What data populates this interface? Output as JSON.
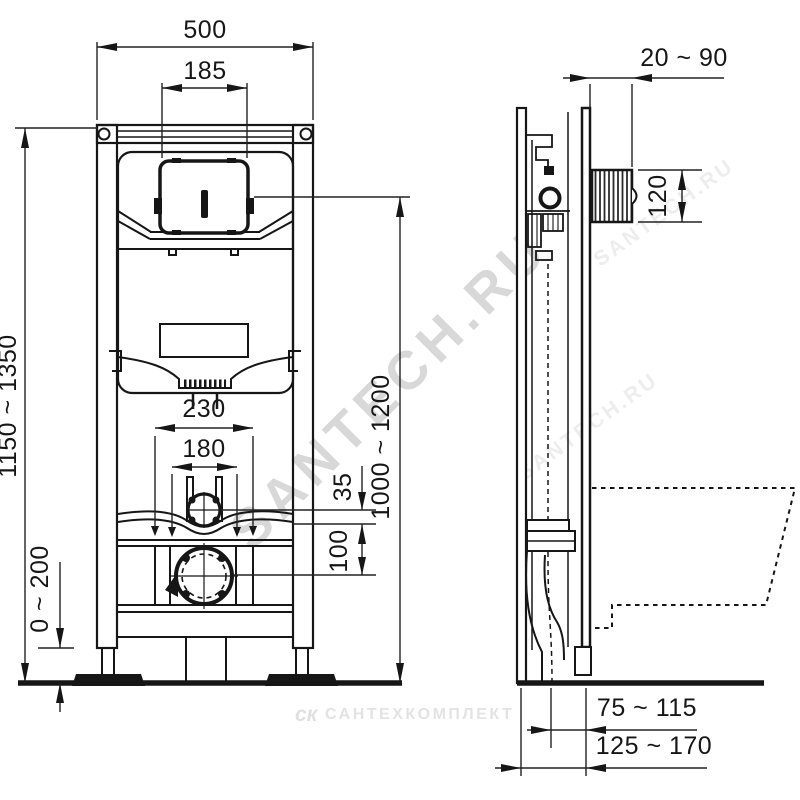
{
  "drawing": {
    "kind": "wall-hung toilet installation frame dimensional drawing",
    "views": {
      "front": "frame front view",
      "side": "frame side view with bowl outline"
    }
  },
  "watermarks": {
    "diagonal_main": "SANTECH.RU",
    "diagonal_faint": "SANTECH.RU",
    "footer_logo": "ск",
    "footer_text": "САНТЕХКОМПЛЕКТ"
  },
  "front_view": {
    "dims": {
      "frame_width": "500",
      "flush_panel_width": "185",
      "frame_height": "1150 ~ 1350",
      "leg_adjustment": "0 ~ 200",
      "fixing_width_outer": "230",
      "fixing_width_inner": "180",
      "flush_pipe_offset": "35",
      "outlet_offset": "100",
      "panel_height": "1000 ~ 1200"
    }
  },
  "side_view": {
    "dims": {
      "wall_distance": "20 ~ 90",
      "access_box_height": "120",
      "outlet_to_wall": "75 ~ 115",
      "frame_depth": "125 ~ 170"
    }
  },
  "colors": {
    "line": "#161616",
    "watermark": "#d8d8d8",
    "background": "#ffffff"
  }
}
